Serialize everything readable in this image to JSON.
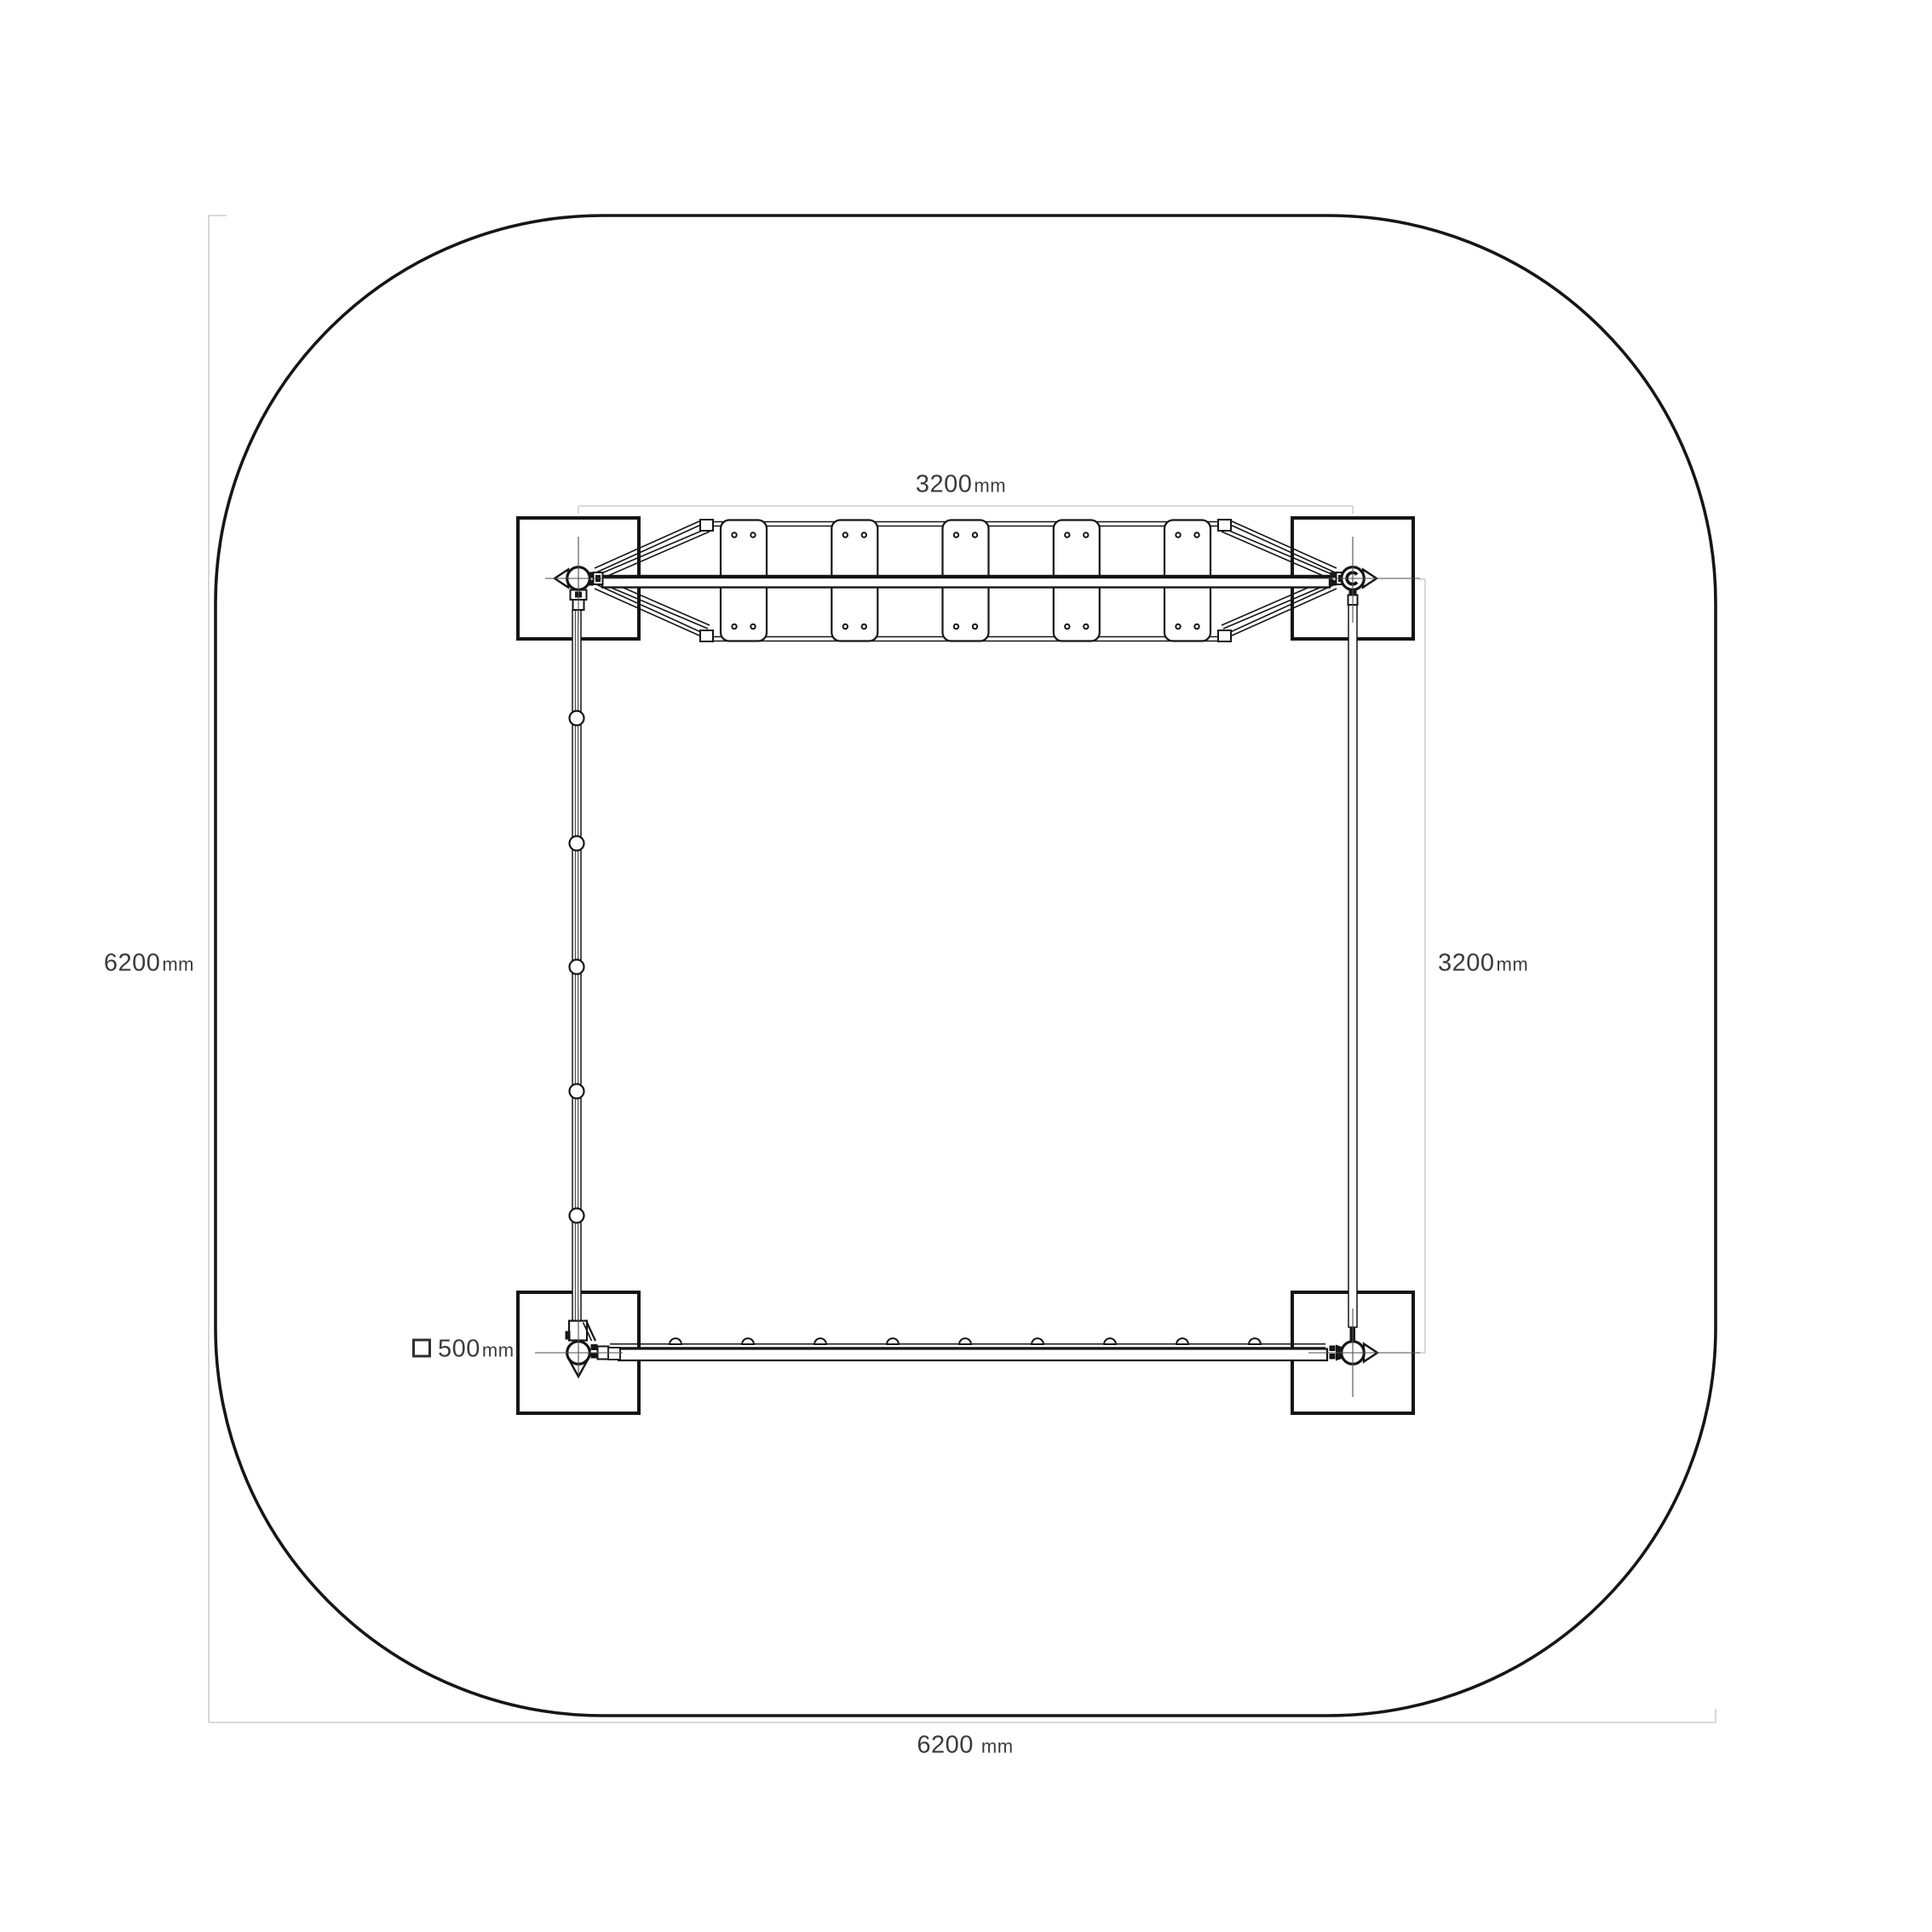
{
  "page": {
    "background": "#ffffff"
  },
  "dimensions": {
    "top": {
      "value": "3200",
      "unit": "mm"
    },
    "right": {
      "value": "3200",
      "unit": "mm"
    },
    "left": {
      "value": "6200",
      "unit": "mm"
    },
    "bottom": {
      "value": "6200",
      "unit": "mm"
    },
    "foundation": {
      "value": "500",
      "unit": "mm"
    }
  },
  "structure": {
    "foundation_pads": 4,
    "corner_posts": 4,
    "bridge_planks": 5,
    "holes_per_plank": 4,
    "rope_balls": 5,
    "rail_knobs": 9
  },
  "colors": {
    "outline": "#161616",
    "dimension_line": "#c1c4c6",
    "crosshair": "#4f4f4f",
    "label_text": "#3b3b3b",
    "background": "#ffffff"
  }
}
